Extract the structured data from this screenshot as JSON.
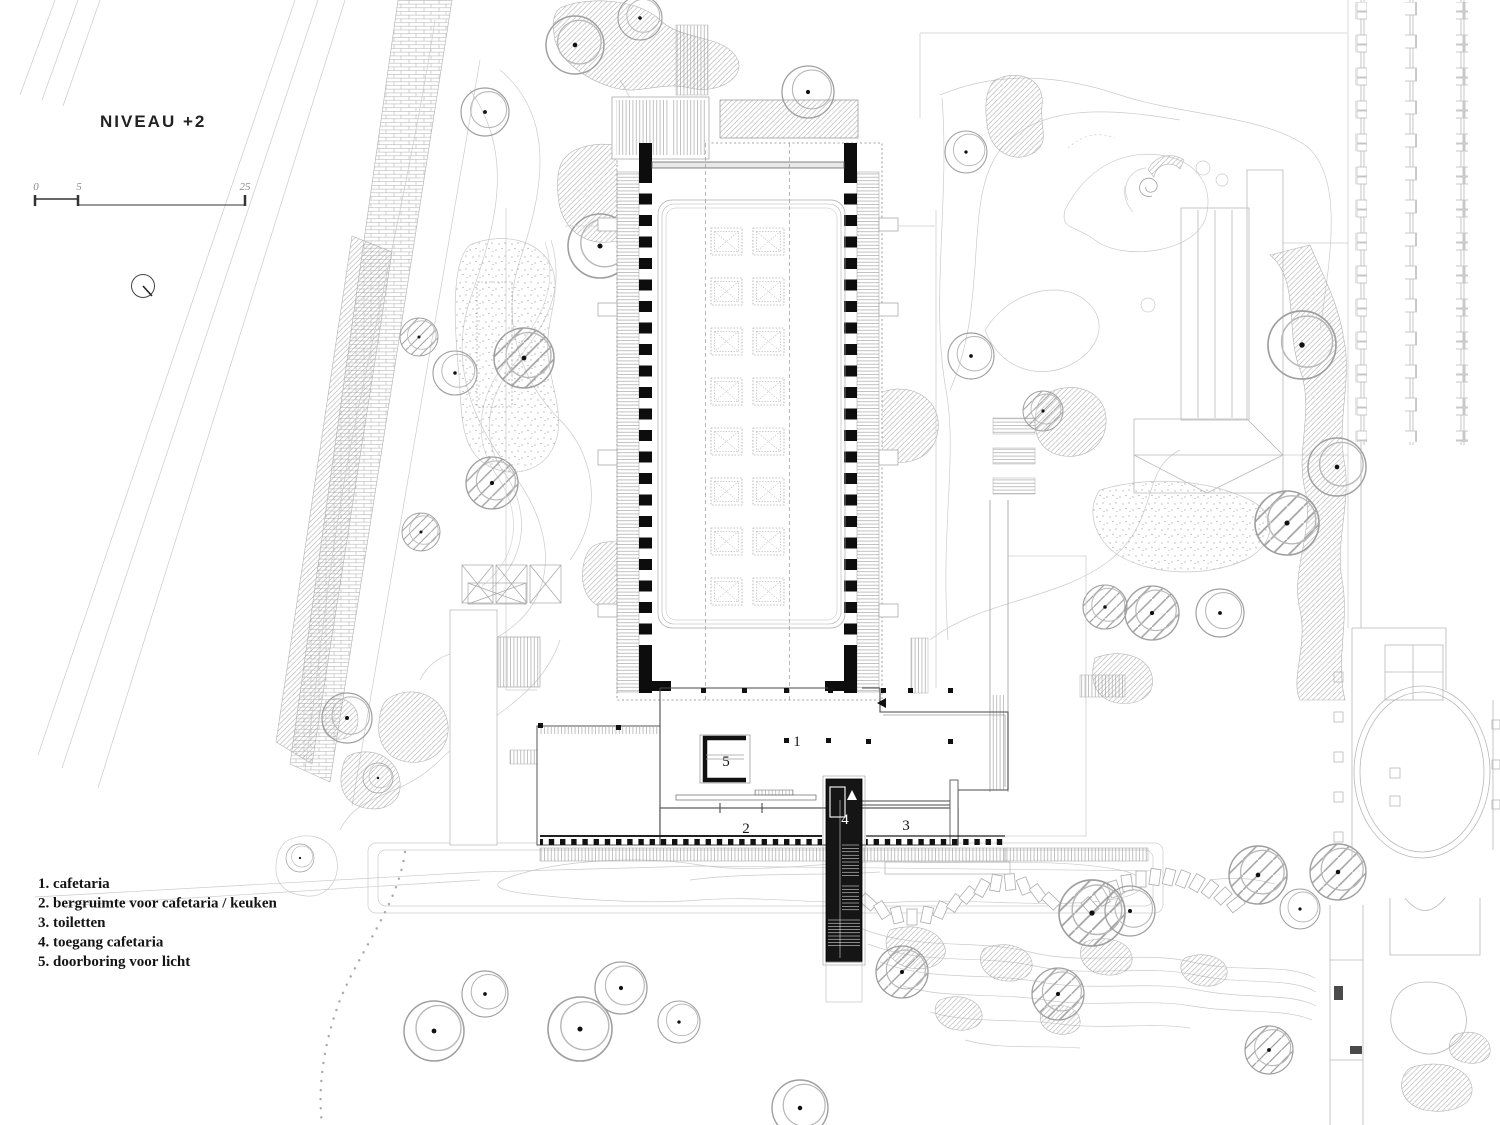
{
  "title": {
    "text": "NIVEAU +2"
  },
  "scale_bar": {
    "labels": [
      "0",
      "5",
      "25"
    ]
  },
  "legend": {
    "items": [
      "1. cafetaria",
      "2. bergruimte voor cafetaria / keuken",
      "3. toiletten",
      "4. toegang cafetaria",
      "5. doorboring voor licht"
    ]
  },
  "plan_labels": {
    "cafetaria": "1",
    "storage": "2",
    "toilets": "3",
    "entrance": "4",
    "light_opening": "5"
  },
  "colors": {
    "ink": "#141414",
    "faint_line": "#c9c9c9",
    "paper": "#ffffff"
  }
}
